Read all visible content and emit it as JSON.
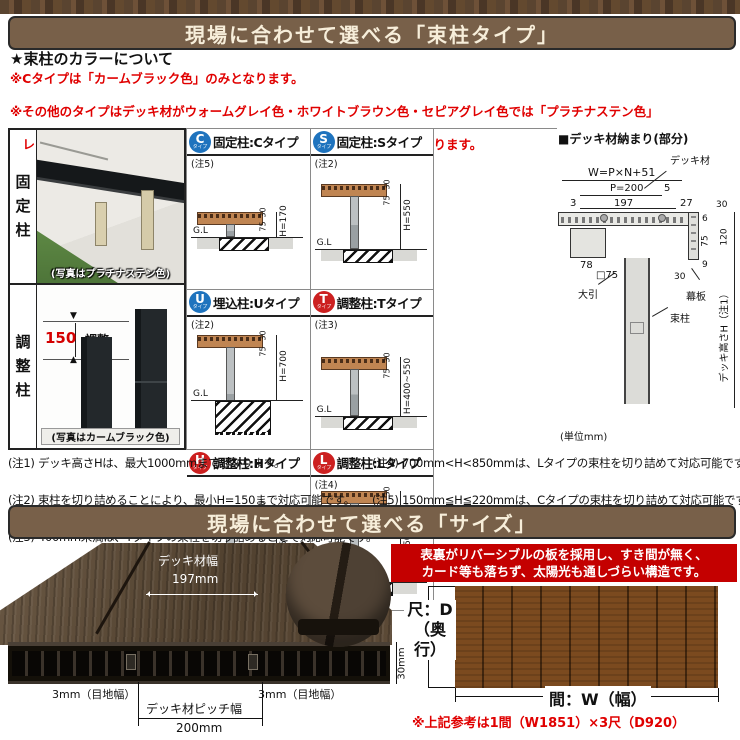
{
  "banner1": {
    "title": "現場に合わせて選べる「束柱タイプ」"
  },
  "banner2": {
    "title": "現場に合わせて選べる「サイズ」"
  },
  "color_section": {
    "heading": "★束柱のカラーについて",
    "line1": "※Cタイプは「カームブラック色」のみとなります。",
    "line2": "※その他のタイプはデッキ材がウォームグレイ色・ホワイトブラウン色・セピアグレイ色では「プラチナステン色」",
    "line3": "　レッドブラウン色・ナチュラルブラウン色では「カームブラック色」となります。"
  },
  "post_types": {
    "rows": [
      {
        "label": "固定柱",
        "caption": "(写真はプラチナステン色)"
      },
      {
        "label": "調整柱",
        "caption": "(写真はカームブラック色)",
        "adjust_value": "150",
        "adjust_label": "調整"
      }
    ],
    "cells": [
      {
        "letter": "C",
        "sub": "タイプ",
        "title": "固定柱:Cタイプ",
        "note": "(注5)",
        "d30": "30",
        "d75": "75",
        "h": "H=170",
        "gl": "G.L"
      },
      {
        "letter": "S",
        "sub": "タイプ",
        "title": "固定柱:Sタイプ",
        "note": "(注2)",
        "d30": "30",
        "d75": "75",
        "h": "H=550",
        "gl": "G.L"
      },
      {
        "letter": "U",
        "sub": "タイプ",
        "title": "埋込柱:Uタイプ",
        "note": "(注2)",
        "d30": "30",
        "d75": "75",
        "h": "H=700",
        "gl": "G.L"
      },
      {
        "letter": "T",
        "sub": "タイプ",
        "title": "調整柱:Tタイプ",
        "note": "(注3)",
        "d30": "30",
        "d75": "75",
        "h": "H=400~550",
        "gl": "G.L"
      },
      {
        "letter": "H",
        "sub": "タイプ",
        "title": "調整柱:Hタイプ",
        "note": "",
        "d30": "30",
        "d75": "75",
        "h": "H=550~700",
        "gl": "G.L"
      },
      {
        "letter": "L",
        "sub": "タイプ",
        "title": "調整柱:Lタイプ",
        "note": "(注4)",
        "d30": "30",
        "d75": "75",
        "h": "H=850~1000",
        "gl": "G.L"
      }
    ],
    "unit": "(単位mm)"
  },
  "detail_panel": {
    "title": "■デッキ材納まり(部分)",
    "deck_label": "デッキ材",
    "w_formula": "W=P×N+51",
    "p": "P=200",
    "d3": "3",
    "d197": "197",
    "d5": "5",
    "d27": "27",
    "d6": "6",
    "d30_top": "30",
    "d120": "120",
    "d75": "75",
    "d9": "9",
    "d30_bottom": "30",
    "d78": "78",
    "obiki": "大引",
    "sq75": "□75",
    "makuita": "幕板",
    "tsuka": "束柱",
    "height_label": "デッキ高さH（注1）"
  },
  "notes": {
    "n1": "(注1) デッキ高さHは、最大1000mmまでとなります。",
    "n2": "(注2) 束柱を切り詰めることにより、最小H=150まで対応可能です。",
    "n3": "(注3) 400mm未満は、Tタイプの束柱を切り詰めることで対応可能です。",
    "n4": "(注4) 700mm<H<850mmは、Lタイプの束柱を切り詰めて対応可能です。",
    "n5": "(注5) 150mm≦H≦220mmは、Cタイプの束柱を切り詰めて対応可能です。"
  },
  "size_section": {
    "deck_width_label": "デッキ材幅",
    "deck_width_value": "197mm",
    "joint_left": "3mm（目地幅）",
    "joint_right": "3mm（目地幅）",
    "pitch_label": "デッキ材ピッチ幅",
    "pitch_value": "200mm",
    "thickness": "30mm",
    "feature_line1": "表裏がリバーシブルの板を採用し、すき間が無く、",
    "feature_line2": "カード等も落ちず、太陽光も通しづらい構造です。",
    "depth_line1": "尺：D",
    "depth_line2": "（奥行）",
    "width_label": "間：W（幅）",
    "ref_note": "※上記参考は1間（W1851）×3尺（D920）"
  },
  "colors": {
    "banner_brown": "#786049",
    "note_red": "#e00000",
    "feature_box_red": "#c40000",
    "badge_blue": "#1e73be",
    "badge_red": "#cc2020"
  }
}
